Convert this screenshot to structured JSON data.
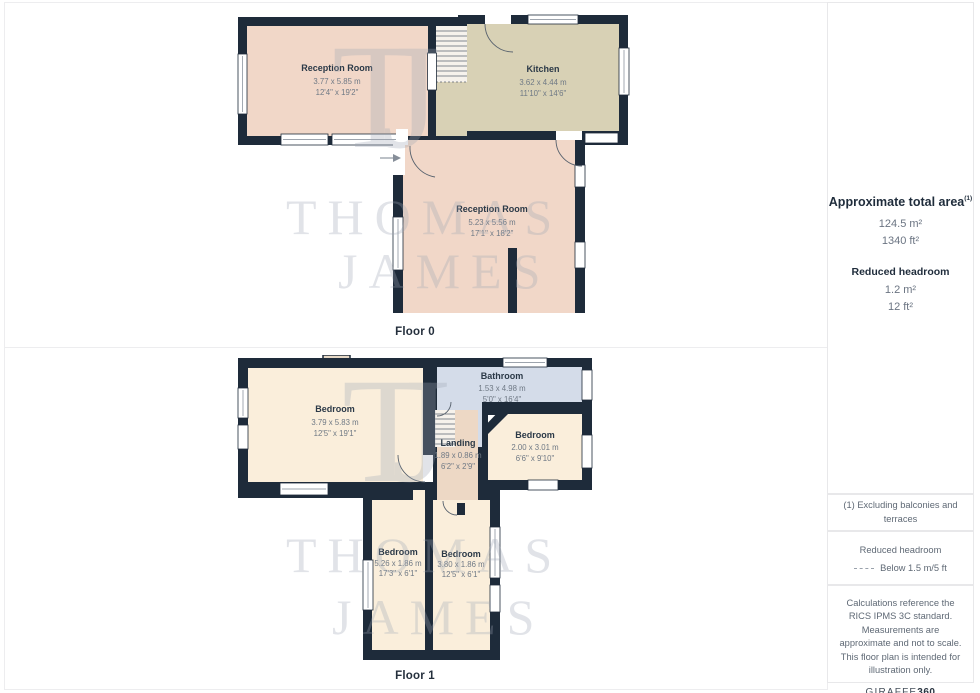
{
  "floors": [
    {
      "label": "Floor 0",
      "rooms": [
        {
          "name": "Reception Room",
          "dim_m": "3.77 x 5.85 m",
          "dim_ft": "12'4\" x 19'2\""
        },
        {
          "name": "Kitchen",
          "dim_m": "3.62 x 4.44 m",
          "dim_ft": "11'10\" x 14'6\""
        },
        {
          "name": "Reception Room",
          "dim_m": "5.23 x 5.56 m",
          "dim_ft": "17'1\" x 18'2\""
        }
      ]
    },
    {
      "label": "Floor 1",
      "rooms": [
        {
          "name": "Bedroom",
          "dim_m": "3.79 x 5.83 m",
          "dim_ft": "12'5\" x 19'1\""
        },
        {
          "name": "Bathroom",
          "dim_m": "1.53 x 4.98 m",
          "dim_ft": "5'0\" x 16'4\""
        },
        {
          "name": "Landing",
          "dim_m": "1.89 x 0.86 m",
          "dim_ft": "6'2\" x 2'9\""
        },
        {
          "name": "Bedroom",
          "dim_m": "2.00 x 3.01 m",
          "dim_ft": "6'6\" x 9'10\""
        },
        {
          "name": "Bedroom",
          "dim_m": "5.26 x 1.86 m",
          "dim_ft": "17'3\" x 6'1\""
        },
        {
          "name": "Bedroom",
          "dim_m": "3.80 x 1.86 m",
          "dim_ft": "12'5\" x 6'1\""
        }
      ]
    }
  ],
  "watermark": {
    "monogram": "TJ",
    "word1": "THOMAS",
    "word2": "JAMES"
  },
  "sidebar": {
    "title": "Approximate total area",
    "title_sup": "(1)",
    "total_m2": "124.5 m²",
    "total_ft2": "1340 ft²",
    "reduced_title": "Reduced headroom",
    "reduced_m2": "1.2 m²",
    "reduced_ft2": "12 ft²",
    "note": "(1) Excluding balconies and terraces",
    "legend_title": "Reduced headroom",
    "legend_value": "Below 1.5 m/5 ft",
    "disclaimer": "Calculations reference the RICS IPMS 3C standard. Measurements are approximate and not to scale. This floor plan is intended for illustration only.",
    "brand_name": "GIRAFFE",
    "brand_suffix": "360"
  },
  "colors": {
    "wall": "#1e2b3a",
    "reception": "#f1d7c8",
    "kitchen": "#d8d1b5",
    "bedroom": "#faeedb",
    "bathroom": "#d4dce9",
    "landing": "#edd8c5"
  }
}
